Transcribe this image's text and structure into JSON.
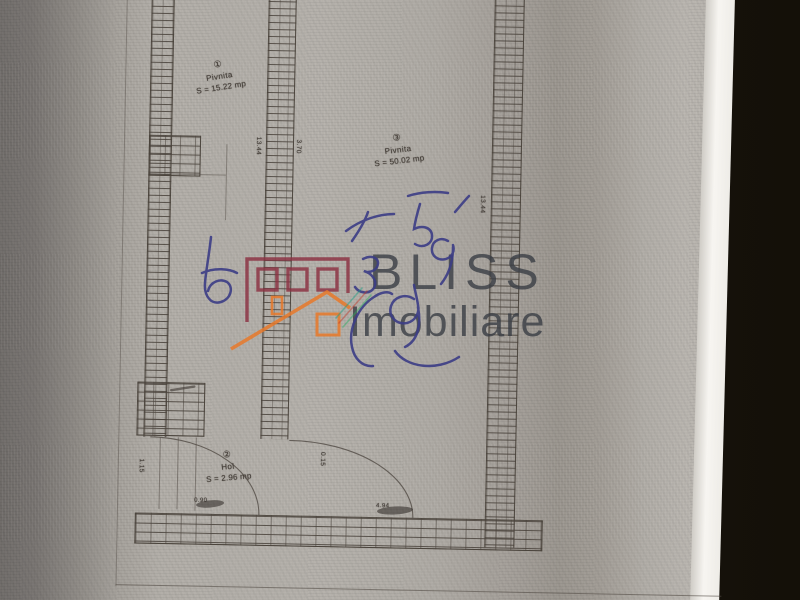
{
  "scene": {
    "backdrop_color": "#18140f",
    "paper_color": "#b2aea8",
    "paper_edge_color": "#f6f4f0"
  },
  "watermark": {
    "brand_top": "BLISS",
    "brand_bottom": "Imobiliare",
    "text_color": "#3a3e45",
    "building_icon_color": "#8c3142",
    "house_icon_color": "#e8792a"
  },
  "plan": {
    "rooms": [
      {
        "number": "①",
        "name": "Pivnita",
        "area": "S = 15.22 mp"
      },
      {
        "number": "③",
        "name": "Pivnita",
        "area": "S = 50.02 mp"
      },
      {
        "number": "②",
        "name": "Hol",
        "area": "S = 2.96 mp"
      }
    ],
    "dimensions": {
      "mid_wall_left": "13.44",
      "mid_wall_right": "3.70",
      "right_wall": "13.44",
      "hall_left": "1.15",
      "hall_door": "0.90",
      "room3_door": "4.94",
      "arc_note": "0.15"
    }
  }
}
